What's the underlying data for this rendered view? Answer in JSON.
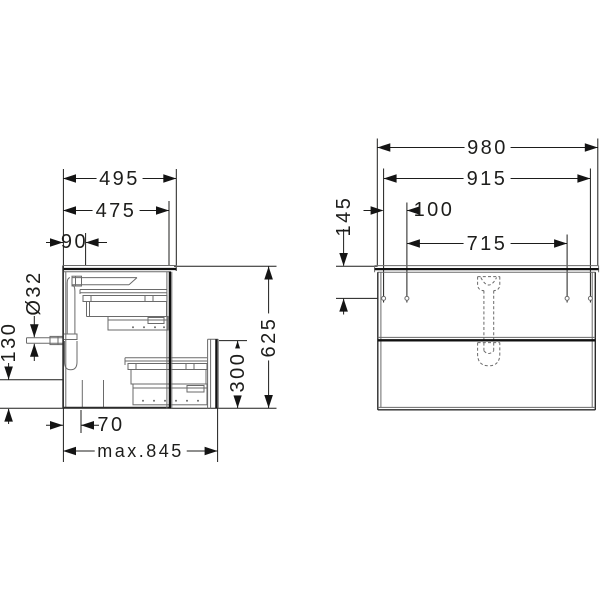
{
  "colors": {
    "background": "#ffffff",
    "line": "#1d1d1b"
  },
  "side_view": {
    "dim_depth_countertop": "495",
    "dim_depth_carcass": "475",
    "dim_drain_offset_from_wall": "90",
    "dim_drain_pipe_diameter": "Ø32",
    "dim_drain_clearance_height": "130",
    "dim_siphon_recess_depth": "70",
    "dim_max_pullout_depth": "max.845",
    "dim_drawer_front_height": "300",
    "dim_overall_height": "625"
  },
  "front_view": {
    "dim_overall_width": "980",
    "dim_mounting_span_outer": "915",
    "dim_mounting_hole_spacing": "100",
    "dim_mounting_span_inner": "715",
    "dim_mounting_height_from_top": "145"
  }
}
